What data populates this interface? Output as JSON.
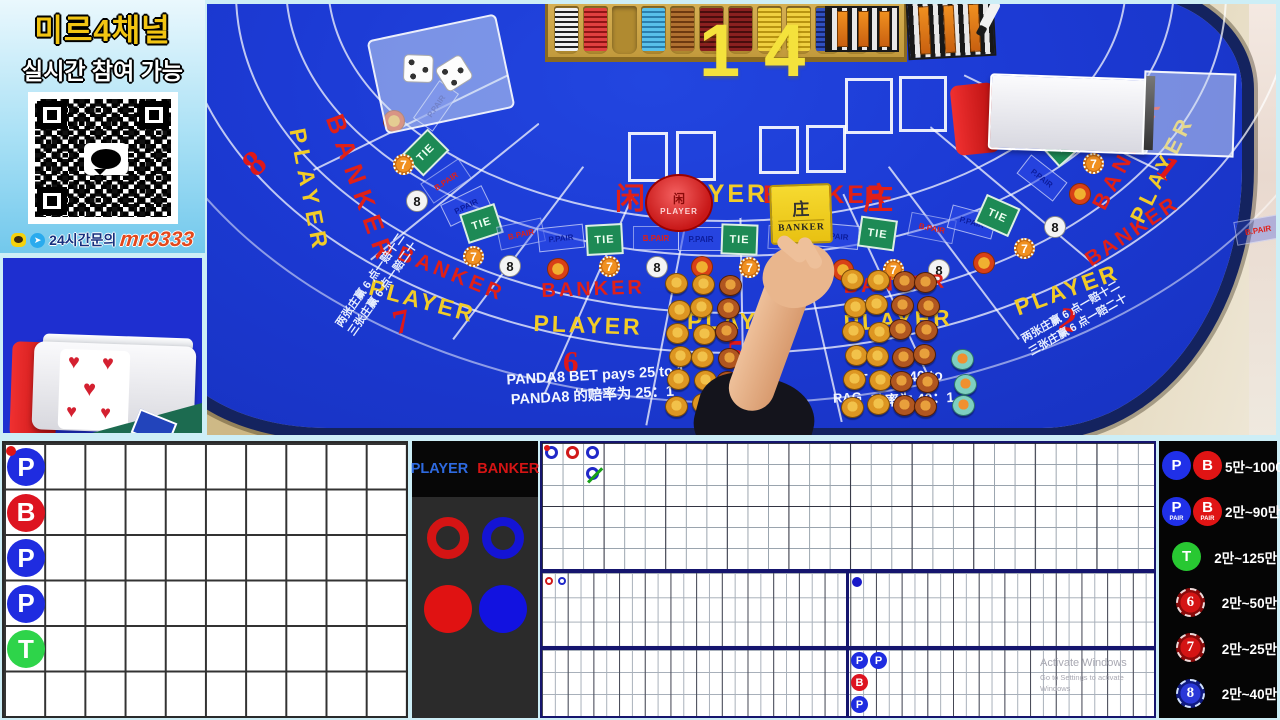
{
  "promo": {
    "title": "미르4채널",
    "subtitle": "실시간 참여 가능",
    "contact_label": "24시간문의",
    "contact_id": "mr9333"
  },
  "counter": "14",
  "legend": {
    "player": "PLAYER",
    "banker": "BANKER"
  },
  "watermark": {
    "l1": "Activate Windows",
    "l2": "Go to Settings to activate Windows"
  },
  "table": {
    "player_cn": "闲",
    "player": "PLAYER",
    "banker": "BANKER",
    "banker_cn": "庄",
    "dolly_cn": "闲",
    "dolly_label": "PLAYER",
    "marker_cn": "庄",
    "marker_label": "BANKER",
    "box_labels": {
      "tie": "TIE",
      "pp": "P.PAIR",
      "bp": "B.PAIR"
    },
    "panda_en": "PANDA8 BET pays 25 to 1",
    "panda_cn": "PANDA8 的赔率为 25：1",
    "dragon_en": "T pays 40 to",
    "dragon_frag": "RAG",
    "dragon_cn": "赔率为 40：1",
    "note1": "两张庄赢 6 点一赔十二",
    "note2": "三张庄赢 6 点一赔二十",
    "seats": [
      {
        "n": "8",
        "x": 38,
        "y": 138,
        "r": -42,
        "s": 36
      },
      {
        "n": "7",
        "x": 186,
        "y": 300,
        "r": -12,
        "s": 34
      },
      {
        "n": "6",
        "x": 356,
        "y": 340,
        "r": 0,
        "s": 31
      },
      {
        "n": "5",
        "x": 520,
        "y": 330,
        "r": 0,
        "s": 34
      },
      {
        "n": "2",
        "x": 852,
        "y": 298,
        "r": 10,
        "s": 34
      },
      {
        "n": "1",
        "x": 952,
        "y": 146,
        "r": 38,
        "s": 34
      }
    ],
    "arc_texts": [
      {
        "t": "BANKER",
        "c": "r",
        "x": 141,
        "y": 106,
        "r": 70,
        "s": 26,
        "ls": 8
      },
      {
        "t": "PLAYER",
        "c": "y",
        "x": 103,
        "y": 122,
        "r": 79,
        "s": 23,
        "ls": 6
      },
      {
        "t": "BANKER",
        "c": "r",
        "x": 196,
        "y": 238,
        "r": 22,
        "s": 21,
        "ls": 4
      },
      {
        "t": "PLAYER",
        "c": "y",
        "x": 166,
        "y": 270,
        "r": 15,
        "s": 23,
        "ls": 3
      },
      {
        "t": "BANKER",
        "c": "r",
        "x": 334,
        "y": 276,
        "r": -2,
        "s": 20,
        "ls": 3
      },
      {
        "t": "PLAYER",
        "c": "y",
        "x": 327,
        "y": 306,
        "r": 2,
        "s": 23,
        "ls": 3
      },
      {
        "t": "PLAYER",
        "c": "y",
        "x": 480,
        "y": 304,
        "r": 0,
        "s": 23,
        "ls": 3
      },
      {
        "t": "BANKER",
        "c": "r",
        "x": 636,
        "y": 272,
        "r": -3,
        "s": 20,
        "ls": 3
      },
      {
        "t": "PLAYER",
        "c": "y",
        "x": 636,
        "y": 306,
        "r": -3,
        "s": 23,
        "ls": 3
      },
      {
        "t": "PLAYER",
        "c": "y",
        "x": 804,
        "y": 292,
        "r": -20,
        "s": 23,
        "ls": 3
      },
      {
        "t": "BANKER",
        "c": "r",
        "x": 874,
        "y": 248,
        "r": -34,
        "s": 21,
        "ls": 3
      },
      {
        "t": "BANKER",
        "c": "r",
        "x": 880,
        "y": 198,
        "r": -62,
        "s": 22,
        "ls": 5
      },
      {
        "t": "PLAYER",
        "c": "y",
        "x": 918,
        "y": 212,
        "r": -64,
        "s": 22,
        "ls": 5
      }
    ],
    "bet_boxes": [
      {
        "x": 206,
        "y": 90,
        "r": -55,
        "k": "pp"
      },
      {
        "x": 200,
        "y": 133,
        "r": -45,
        "k": "tie"
      },
      {
        "x": 216,
        "y": 165,
        "r": -34,
        "k": "bp"
      },
      {
        "x": 236,
        "y": 190,
        "r": -26,
        "k": "pp"
      },
      {
        "x": 256,
        "y": 204,
        "r": -18,
        "k": "tie"
      },
      {
        "x": 291,
        "y": 218,
        "r": -12,
        "k": "bp"
      },
      {
        "x": 331,
        "y": 222,
        "r": -6,
        "k": "pp"
      },
      {
        "x": 379,
        "y": 220,
        "r": -3,
        "k": "tie"
      },
      {
        "x": 426,
        "y": 222,
        "r": 0,
        "k": "bp"
      },
      {
        "x": 471,
        "y": 223,
        "r": 0,
        "k": "pp"
      },
      {
        "x": 514,
        "y": 220,
        "r": 2,
        "k": "tie"
      },
      {
        "x": 561,
        "y": 222,
        "r": 3,
        "k": "bp"
      },
      {
        "x": 606,
        "y": 220,
        "r": 5,
        "k": "pp"
      },
      {
        "x": 652,
        "y": 214,
        "r": 8,
        "k": "tie"
      },
      {
        "x": 702,
        "y": 212,
        "r": 11,
        "k": "bp"
      },
      {
        "x": 742,
        "y": 206,
        "r": 15,
        "k": "pp"
      },
      {
        "x": 772,
        "y": 196,
        "r": 24,
        "k": "tie"
      },
      {
        "x": 812,
        "y": 162,
        "r": 38,
        "k": "pp"
      },
      {
        "x": 833,
        "y": 124,
        "r": 48,
        "k": "tie"
      },
      {
        "x": 1028,
        "y": 214,
        "r": -10,
        "k": "bp"
      }
    ],
    "chip_icons": [
      {
        "x": 176,
        "y": 106,
        "k": "lucky"
      },
      {
        "x": 186,
        "y": 150,
        "k": "seven"
      },
      {
        "x": 199,
        "y": 186,
        "k": "eight"
      },
      {
        "x": 256,
        "y": 242,
        "k": "seven"
      },
      {
        "x": 292,
        "y": 251,
        "k": "eight"
      },
      {
        "x": 340,
        "y": 254,
        "k": "lucky"
      },
      {
        "x": 392,
        "y": 252,
        "k": "seven"
      },
      {
        "x": 439,
        "y": 252,
        "k": "eight"
      },
      {
        "x": 484,
        "y": 252,
        "k": "lucky"
      },
      {
        "x": 532,
        "y": 253,
        "k": "seven"
      },
      {
        "x": 580,
        "y": 254,
        "k": "eight"
      },
      {
        "x": 625,
        "y": 255,
        "k": "lucky"
      },
      {
        "x": 676,
        "y": 255,
        "k": "seven"
      },
      {
        "x": 721,
        "y": 255,
        "k": "eight"
      },
      {
        "x": 766,
        "y": 248,
        "k": "lucky"
      },
      {
        "x": 807,
        "y": 234,
        "k": "seven"
      },
      {
        "x": 837,
        "y": 212,
        "k": "eight"
      },
      {
        "x": 862,
        "y": 179,
        "k": "lucky"
      },
      {
        "x": 876,
        "y": 149,
        "k": "seven"
      }
    ],
    "chip_icon_seven": "7",
    "chip_icon_eight": "8",
    "chip_stacks": [
      {
        "x": 460,
        "y": 270,
        "cols": 3,
        "rows": 6,
        "dx": 25,
        "dy": 24,
        "colors": [
          "gold",
          "gold",
          "copper"
        ]
      },
      {
        "x": 636,
        "y": 266,
        "cols": 4,
        "rows": 6,
        "dx": 24,
        "dy": 25,
        "colors": [
          "gold",
          "gold",
          "copper",
          "copper"
        ]
      },
      {
        "x": 746,
        "y": 346,
        "cols": 1,
        "rows": 3,
        "dx": 24,
        "dy": 22,
        "colors": [
          "teal"
        ]
      }
    ],
    "card_spots": [
      {
        "x": 421,
        "y": 128,
        "w": 40,
        "h": 50
      },
      {
        "x": 469,
        "y": 127,
        "w": 40,
        "h": 50
      },
      {
        "x": 552,
        "y": 122,
        "w": 40,
        "h": 48
      },
      {
        "x": 599,
        "y": 121,
        "w": 40,
        "h": 48
      },
      {
        "x": 638,
        "y": 74,
        "w": 48,
        "h": 56
      },
      {
        "x": 692,
        "y": 72,
        "w": 48,
        "h": 56
      }
    ],
    "tray_columns": [
      "wb",
      "red",
      "empty",
      "sky",
      "copperS",
      "maroon",
      "maroon",
      "yellow",
      "yellow",
      "navy",
      "copperS",
      "wb"
    ]
  },
  "bead_plate": {
    "cols": 10,
    "rows": 6,
    "entries": [
      {
        "c": 0,
        "r": 0,
        "v": "P",
        "pair": true
      },
      {
        "c": 0,
        "r": 1,
        "v": "B"
      },
      {
        "c": 0,
        "r": 2,
        "v": "P"
      },
      {
        "c": 0,
        "r": 3,
        "v": "P"
      },
      {
        "c": 0,
        "r": 4,
        "v": "T"
      }
    ]
  },
  "big_road": {
    "entries": [
      {
        "c": 0,
        "r": 0,
        "k": "blue",
        "pair": true
      },
      {
        "c": 1,
        "r": 0,
        "k": "red"
      },
      {
        "c": 2,
        "r": 0,
        "k": "blue"
      },
      {
        "c": 2,
        "r": 1,
        "k": "blue",
        "tie": true
      }
    ]
  },
  "mid_road": {
    "left": [
      {
        "c": 0,
        "r": 0,
        "k": "red"
      },
      {
        "c": 1,
        "r": 0,
        "k": "blue"
      }
    ],
    "right": [
      {
        "c": 0,
        "r": 0,
        "k": "blue"
      }
    ]
  },
  "mini_bead": {
    "entries": [
      {
        "c": 0,
        "r": 0,
        "v": "P"
      },
      {
        "c": 1,
        "r": 0,
        "v": "P"
      },
      {
        "c": 0,
        "r": 1,
        "v": "B"
      },
      {
        "c": 0,
        "r": 2,
        "v": "P"
      }
    ]
  },
  "limits": {
    "rows": [
      {
        "icons": [
          {
            "t": "P",
            "c": "blue"
          },
          {
            "t": "B",
            "c": "red"
          }
        ],
        "range": "5만~1000만"
      },
      {
        "icons": [
          {
            "t": "P",
            "sub": "PAIR",
            "c": "blue"
          },
          {
            "t": "B",
            "sub": "PAIR",
            "c": "red"
          }
        ],
        "range": "2만~90만"
      },
      {
        "icons": [
          {
            "t": "T",
            "c": "green"
          }
        ],
        "range": "2만~125만"
      },
      {
        "icons": [
          {
            "t": "6",
            "c": "chipred"
          }
        ],
        "range": "2만~50만"
      },
      {
        "icons": [
          {
            "t": "7",
            "c": "chipred"
          }
        ],
        "range": "2만~25만"
      },
      {
        "icons": [
          {
            "t": "8",
            "c": "chipblue"
          }
        ],
        "range": "2만~40만"
      }
    ]
  }
}
